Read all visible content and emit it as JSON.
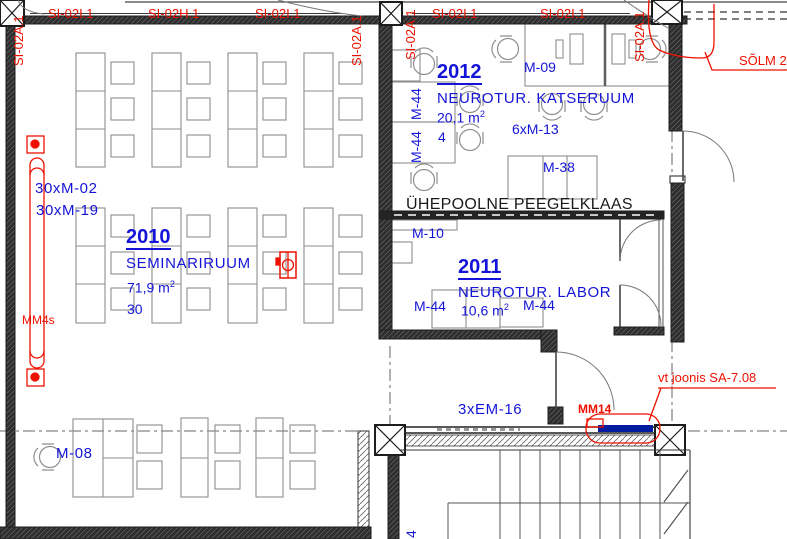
{
  "colors": {
    "annotation_red": "#ee1100",
    "label_blue": "#1414d8",
    "wall": "#232323",
    "furniture_line": "#8e8e8e",
    "mm14_bar": "#001b9e",
    "note_black": "#1a1a1a"
  },
  "grid": {
    "top": [
      "SI-02I.1",
      "SI-02H.1",
      "SI-02I.1",
      "SI-02I.1",
      "SI-02I.1"
    ],
    "vertical": [
      "SI-02A.1",
      "SI-02A.1",
      "SI-02A.1",
      "SI-02A.1"
    ]
  },
  "rooms": {
    "seminariruum": {
      "number": "2010",
      "name": "SEMINARIRUUM",
      "area": "71,9 m",
      "area_sup": "2",
      "capacity": "30"
    },
    "neurotur_labor": {
      "number": "2011",
      "name": "NEUROTUR. LABOR",
      "area": "10,6 m",
      "area_sup": "2"
    },
    "neurotur_katseruum": {
      "number": "2012",
      "name": "NEUROTUR. KATSERUUM",
      "area": "20,1 m",
      "area_sup": "2",
      "capacity": "4"
    }
  },
  "furniture_labels": {
    "m08": "M-08",
    "m09": "M-09",
    "m10": "M-10",
    "m38": "M-38",
    "m44_vert_a": "M-44",
    "m44_vert_b": "M-44",
    "m44_left": "M-44",
    "m44_right": "M-44",
    "qty_m02": "30xM-02",
    "qty_m19": "30xM-19",
    "qty_m13": "6xM-13",
    "qty_em16": "3xEM-16",
    "stair_label": "4"
  },
  "annotations": {
    "solm": "SÕLM 2",
    "vt_joonis": "vt joonis SA-7.08",
    "mm14": "MM14",
    "mm4s": "MM4s",
    "mirror_note": "ÜHEPOOLNE PEEGELKLAAS"
  }
}
